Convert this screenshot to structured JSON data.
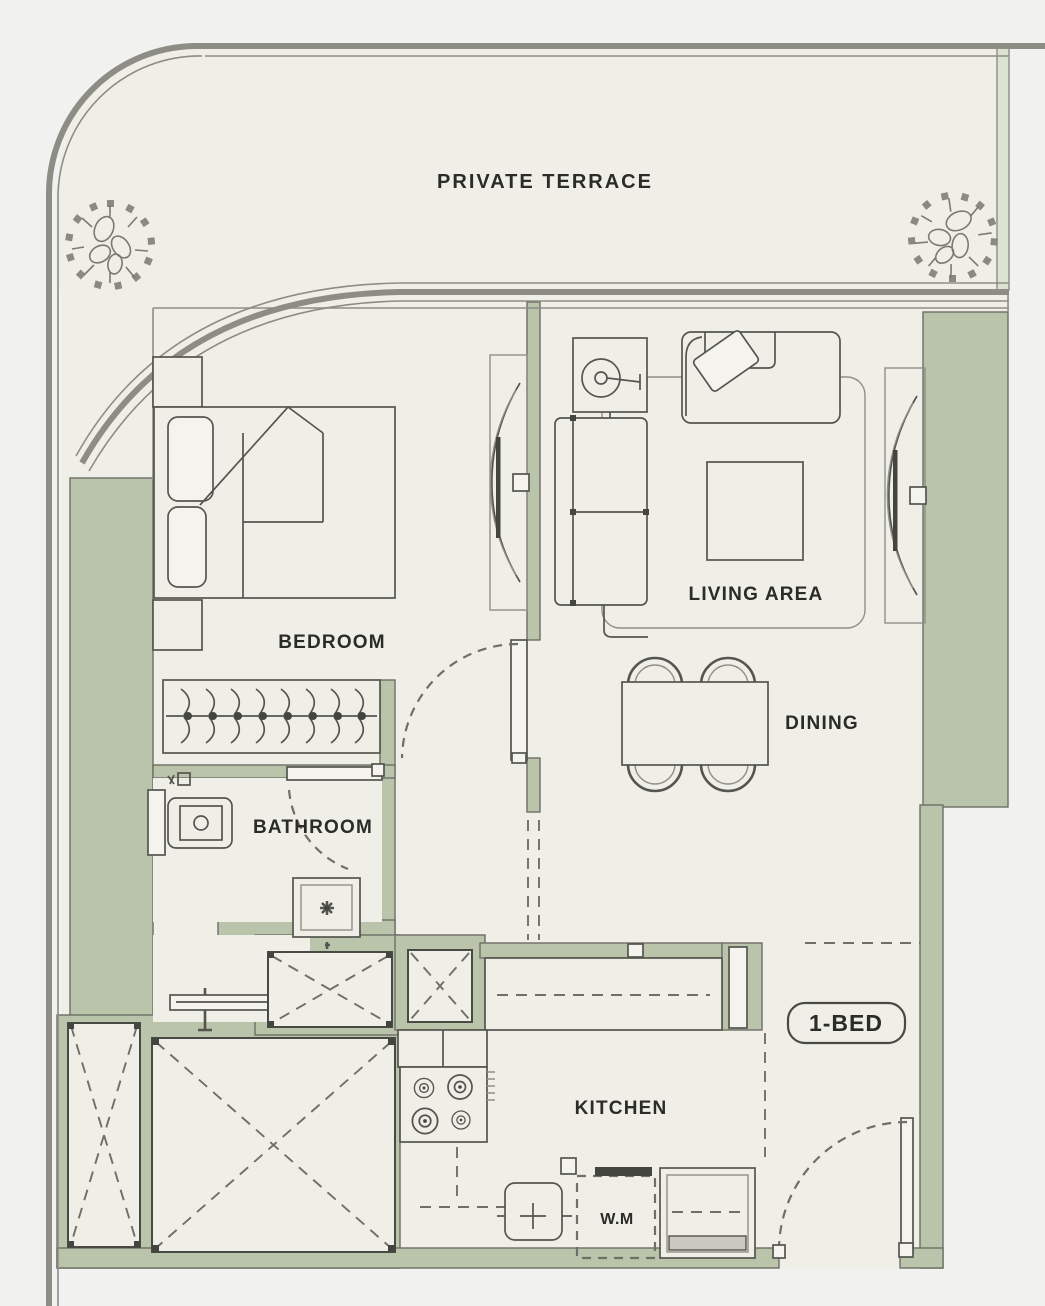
{
  "meta": {
    "kind": "apartment-floor-plan",
    "unit_type": "1-BED"
  },
  "colors": {
    "outside": "#f1f1f0",
    "floor": "#efeee7",
    "wall": "#b9c4ab",
    "wall_light": "#dde3d3",
    "line": "#55554f",
    "wall_stroke": "#6e6e66",
    "thick": "#8d8d86",
    "text": "#2b2b27",
    "dash": "#6f6f68"
  },
  "labels": {
    "terrace": "PRIVATE TERRACE",
    "bedroom": "BEDROOM",
    "living": "LIVING AREA",
    "dining": "DINING",
    "bathroom": "BATHROOM",
    "kitchen": "KITCHEN",
    "washing_machine": "W.M",
    "unit_badge": "1-BED"
  }
}
